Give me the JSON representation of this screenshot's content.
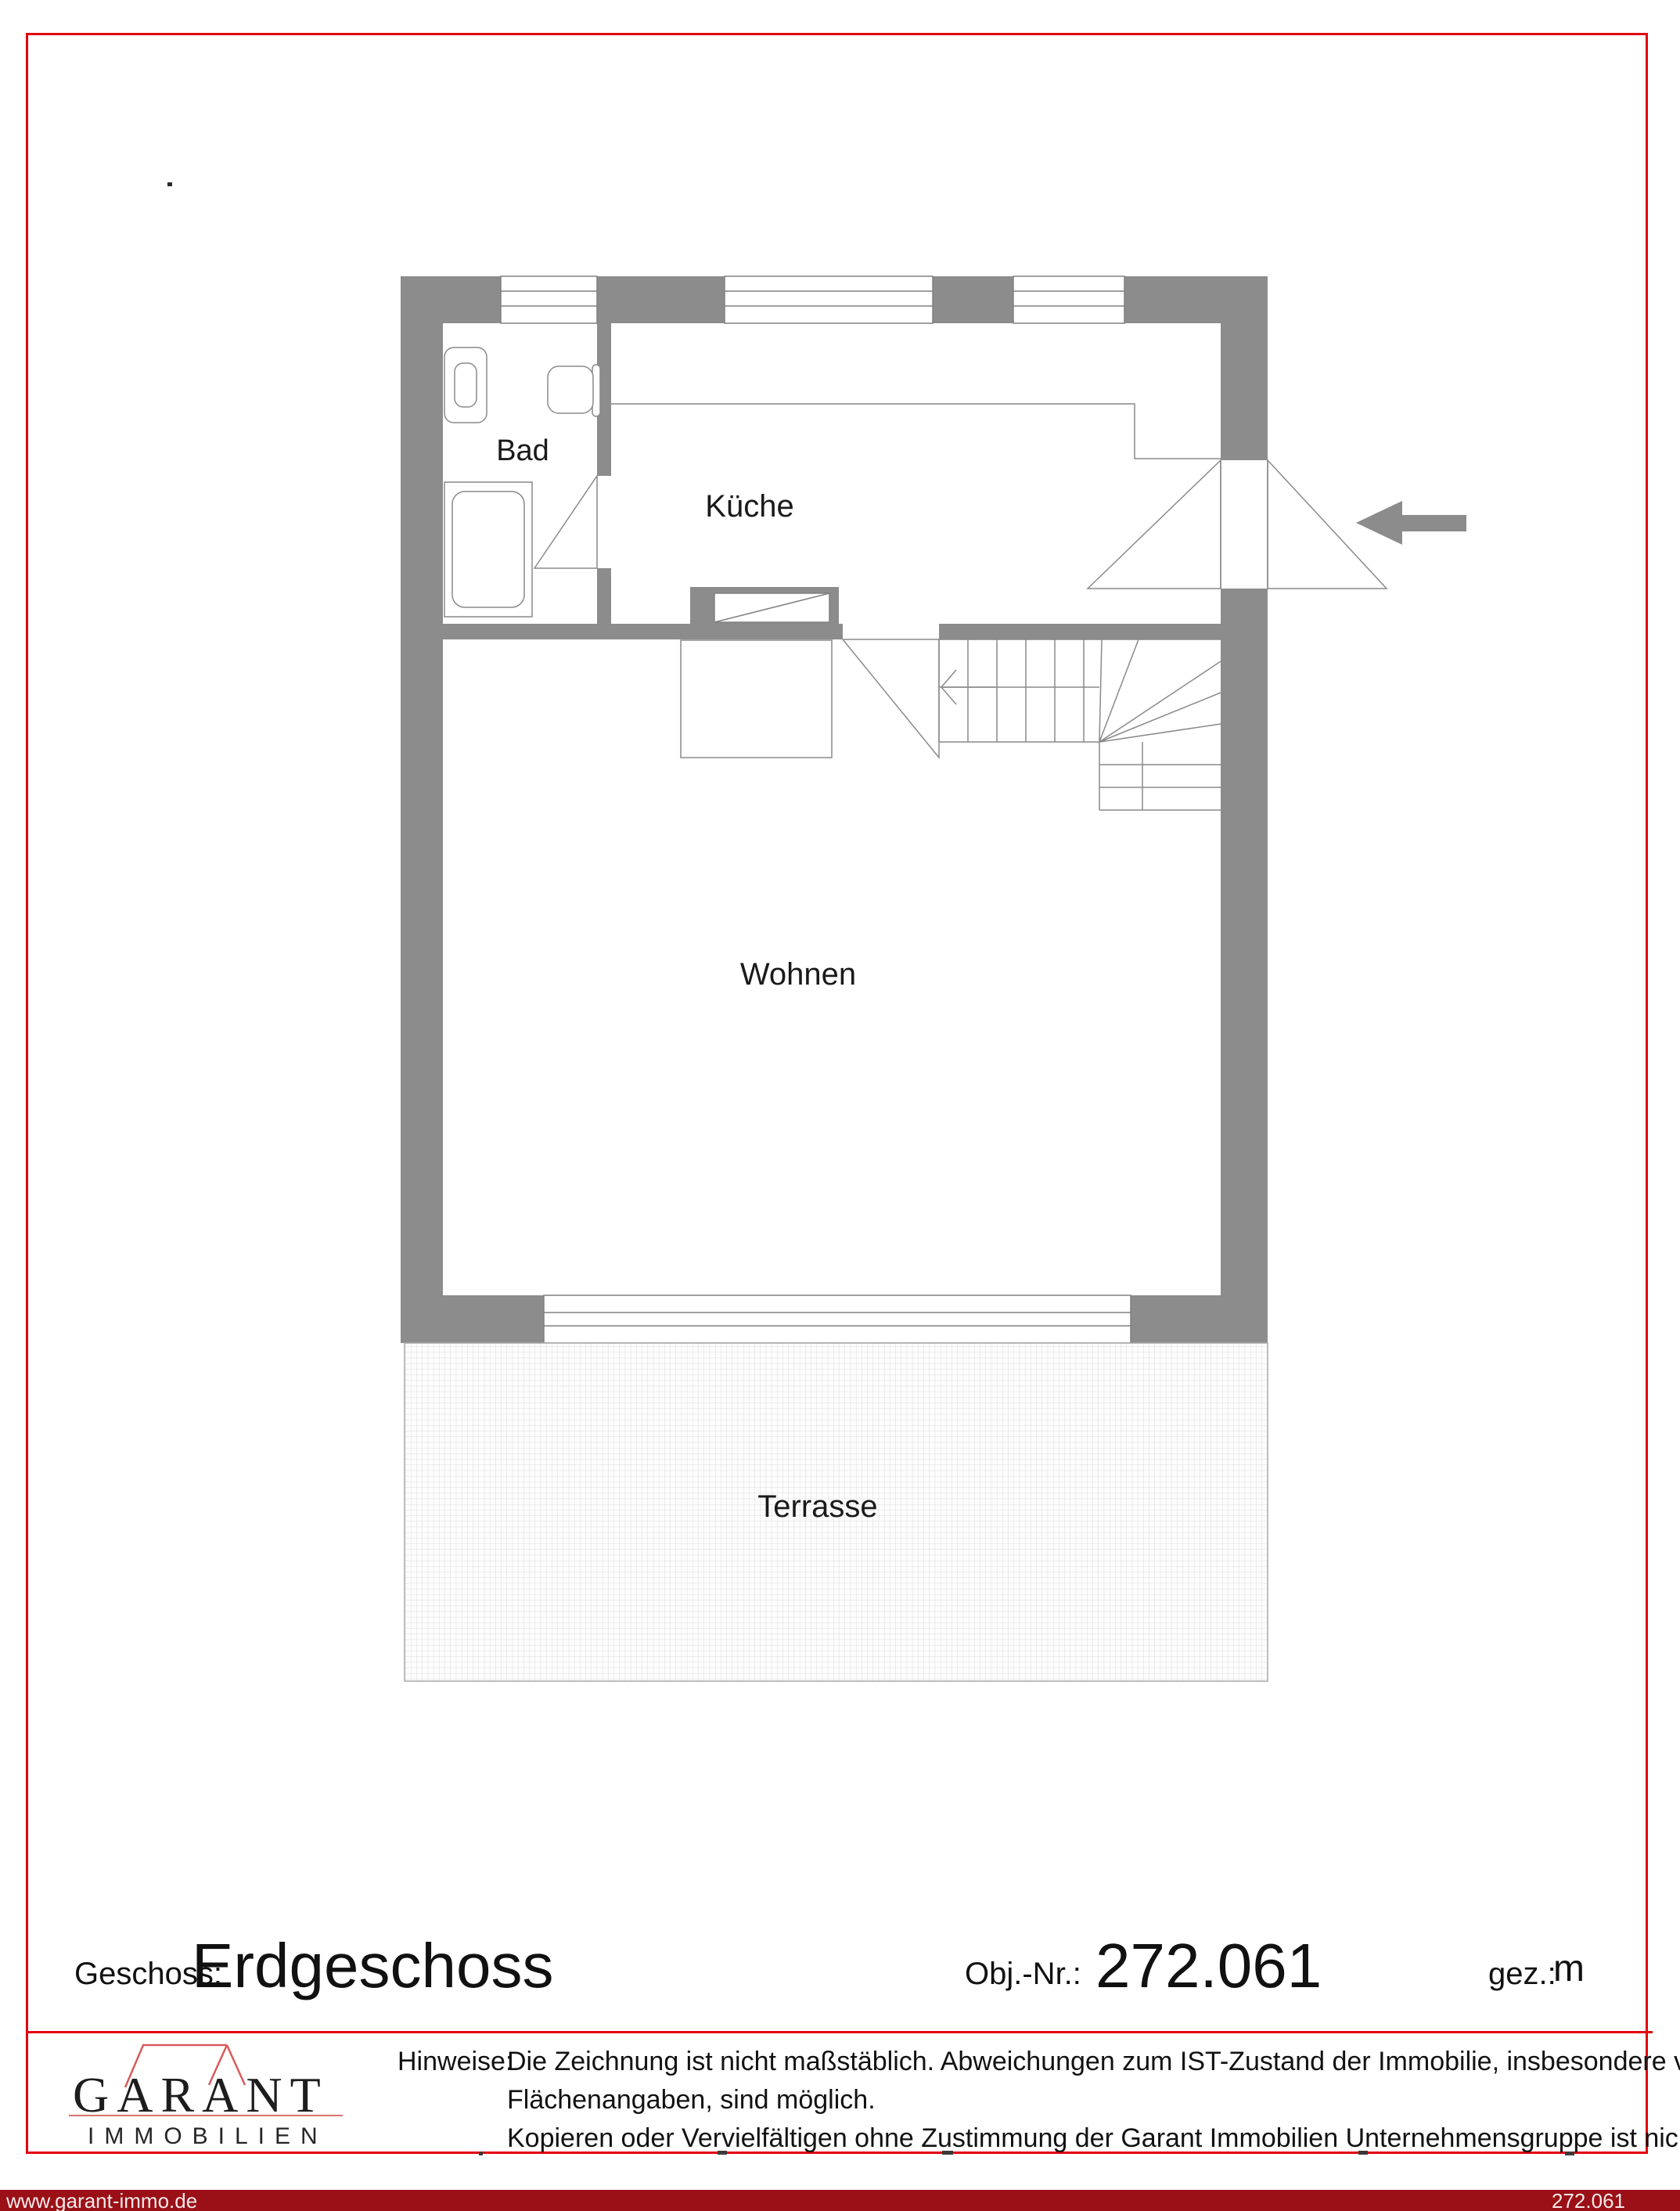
{
  "floorplan": {
    "rooms": {
      "bad": "Bad",
      "kitchen": "Küche",
      "living": "Wohnen",
      "terrace": "Terrasse"
    },
    "wall_color": "#8c8c8c",
    "line_color": "#808080",
    "accent_red": "#e3000f"
  },
  "title_block": {
    "floor_label": "Geschoss:",
    "floor_value": "Erdgeschoss",
    "object_label": "Obj.-Nr.:",
    "object_value": "272.061",
    "drawn_label": "gez.:",
    "drawn_value": "m"
  },
  "footer": {
    "logo_name": "GARANT",
    "logo_subtitle": "IMMOBILIEN",
    "notes_label": "Hinweise:",
    "notes_lines": [
      "Die Zeichnung ist nicht maßstäblich. Abweichungen zum IST-Zustand der Immobilie, insbesondere von Maß- und",
      "Flächenangaben, sind möglich.",
      "Kopieren oder Vervielfältigen ohne Zustimmung der Garant Immobilien Unternehmensgruppe ist nicht gestattet!"
    ]
  },
  "bottom_bar": {
    "website": "www.garant-immo.de",
    "object_number": "272.061",
    "background": "#9a1016"
  }
}
